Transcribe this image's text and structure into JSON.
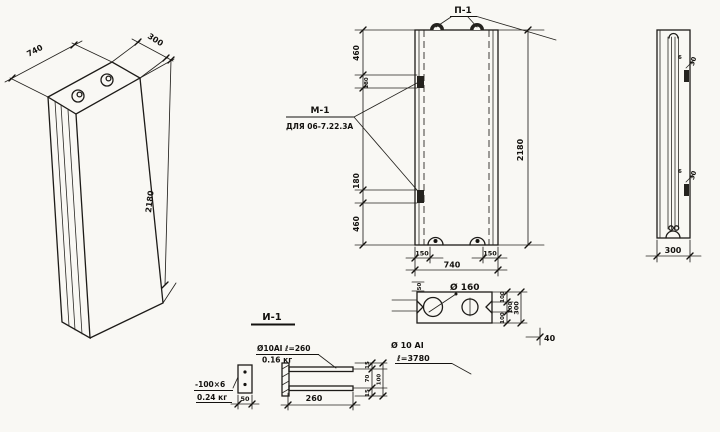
{
  "meta": {
    "ink": "#1d1b18",
    "paper": "#f9f8f4"
  },
  "iso": {
    "dim_width": "740",
    "dim_depth": "300",
    "dim_height": "2180"
  },
  "front": {
    "loop_label": "П-1",
    "embed_label": "М-1",
    "embed_note": "ДЛЯ 06-7.22.3А",
    "dims_left": [
      "460",
      "180",
      "180",
      "460"
    ],
    "dim_height": "2180",
    "dim_loop_left": "150",
    "dim_loop_right": "150",
    "dim_width": "740"
  },
  "section": {
    "hole_label": "Ø 160",
    "notch_dim": "50",
    "dims_right": [
      "100",
      "100",
      "100"
    ],
    "dim_total": "300",
    "dim_offset": "40"
  },
  "detail": {
    "title": "И-1",
    "plate_size": "-100×6",
    "plate_weight": "0.24 кг",
    "plate_width": "50",
    "rod_label": "Ø10АI ℓ=260",
    "rod_weight": "0.16 кг",
    "rod_length": "260",
    "dims_right": [
      "15",
      "70",
      "15"
    ],
    "dim_total": "100",
    "bar_label": "Ø 10 АI",
    "bar_length": "ℓ=3780"
  },
  "side": {
    "plate_gap_top": "6",
    "plate_dim_top": "30",
    "plate_gap_bottom": "6",
    "plate_dim_bottom": "30",
    "dim_depth": "300"
  }
}
